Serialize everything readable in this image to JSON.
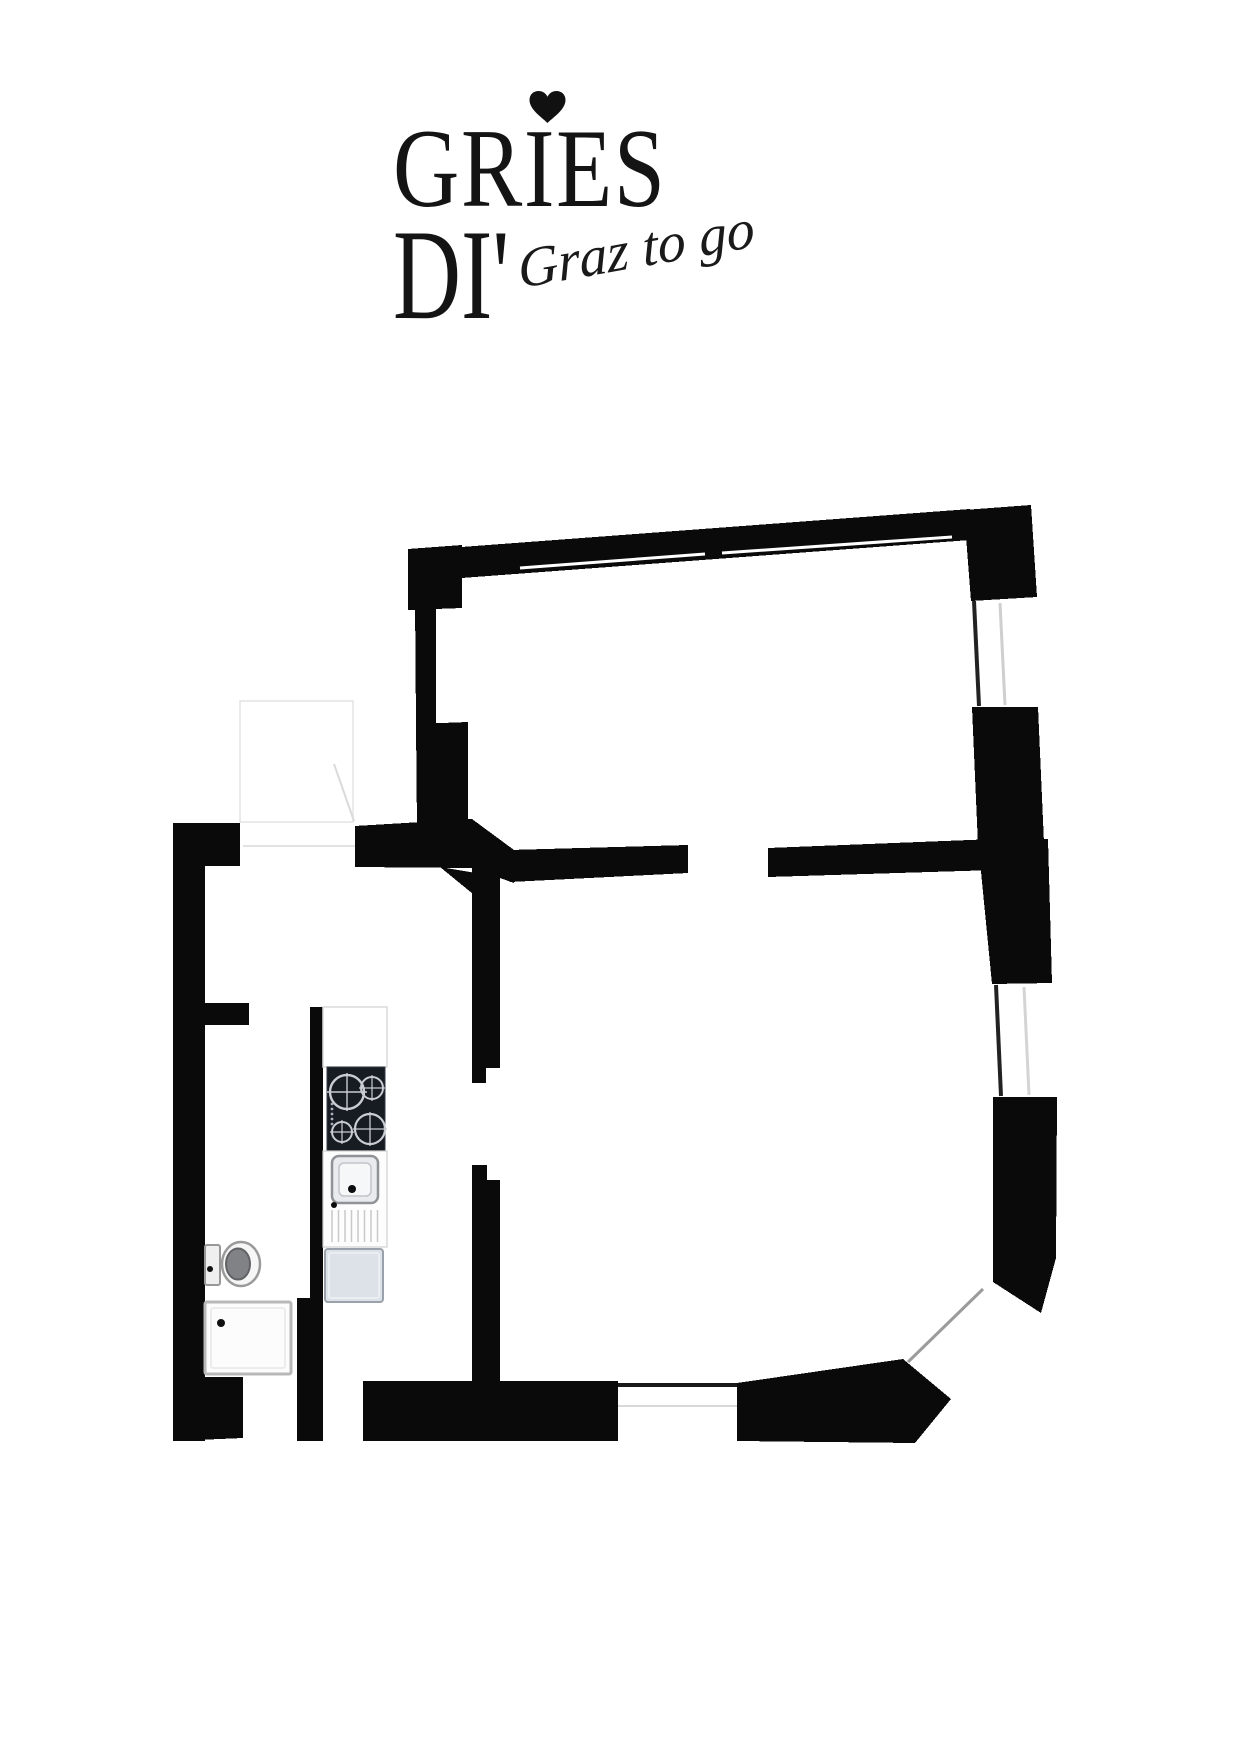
{
  "page": {
    "background": "#ffffff"
  },
  "logo": {
    "heart_icon": "heart-icon",
    "title_line1": "GRIES",
    "title_line2": "DI'",
    "script_text": "Graz to go",
    "text_color": "#141414"
  },
  "floorplan": {
    "wall_color": "#0a0a0a",
    "window_count": 4,
    "fixture_icons": [
      "stove-icon",
      "kitchen-sink-icon",
      "dishwasher-icon",
      "toilet-icon",
      "shower-tray-icon",
      "door-swing-icon"
    ],
    "stove_color": "#171b22",
    "stove_burner_color": "#c9ccd2",
    "appliance_color": "#dde2e9",
    "window_frame_dark": "#222222",
    "window_frame_light": "#cfcfcf"
  }
}
